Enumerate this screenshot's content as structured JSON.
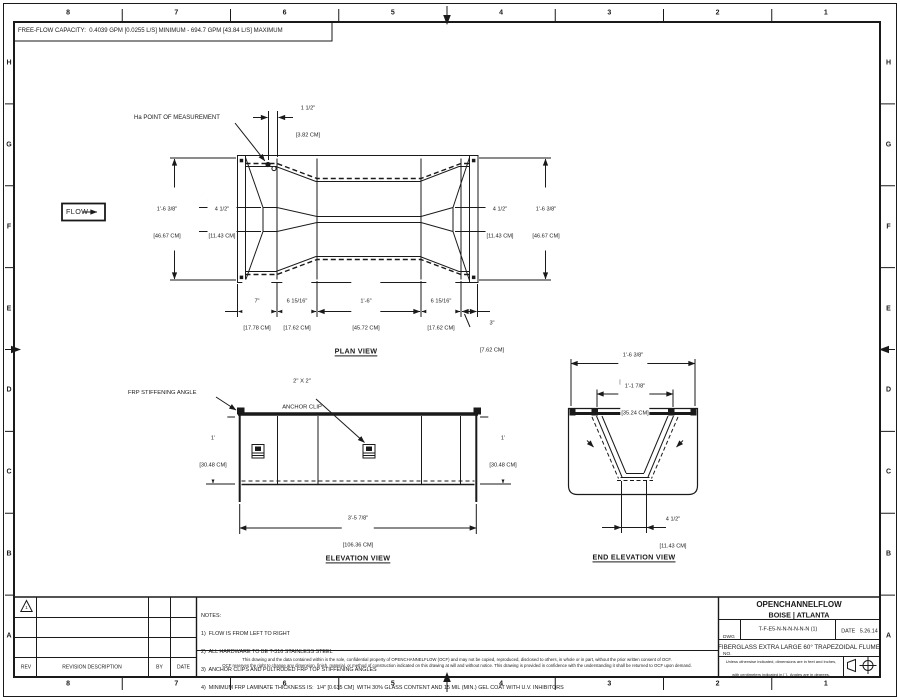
{
  "theme": {
    "line_color": "#1a1a1a",
    "background_color": "#ffffff"
  },
  "sheet": {
    "free_flow_capacity": "FREE-FLOW CAPACITY:  0.4039 GPM [0.0255 L/S] MINIMUM - 694.7 GPM [43.84 L/S] MAXIMUM"
  },
  "border": {
    "cols": [
      "8",
      "7",
      "6",
      "5",
      "4",
      "3",
      "2",
      "1"
    ],
    "rows": [
      "H",
      "G",
      "F",
      "E",
      "D",
      "C",
      "B",
      "A"
    ]
  },
  "plan": {
    "title": "PLAN VIEW",
    "flow_label": "FLOW",
    "ha_label": "Ha POINT OF MEASUREMENT",
    "dims": {
      "gap": {
        "in": "1 1/2\"",
        "cm": "[3.82 CM]"
      },
      "left_width": {
        "in": "1'-6 3/8\"",
        "cm": "[46.67 CM]"
      },
      "left_throat": {
        "in": "4 1/2\"",
        "cm": "[11.43 CM]"
      },
      "right_throat": {
        "in": "4 1/2\"",
        "cm": "[11.43 CM]"
      },
      "right_width": {
        "in": "1'-6 3/8\"",
        "cm": "[46.67 CM]"
      },
      "len1": {
        "in": "7\"",
        "cm": "[17.78 CM]"
      },
      "len2": {
        "in": "6 15/16\"",
        "cm": "[17.62 CM]"
      },
      "len3": {
        "in": "1'-6\"",
        "cm": "[45.72 CM]"
      },
      "len4": {
        "in": "6 15/16\"",
        "cm": "[17.62 CM]"
      },
      "len5": {
        "in": "3\"",
        "cm": "[7.62 CM]"
      }
    }
  },
  "elevation": {
    "title": "ELEVATION VIEW",
    "frp_label": "FRP STIFFENING ANGLE",
    "clip_label_1": "2\" X 2\"",
    "clip_label_2": "ANCHOR CLIP",
    "dims": {
      "height_left": {
        "in": "1'",
        "cm": "[30.48 CM]"
      },
      "height_right": {
        "in": "1'",
        "cm": "[30.48 CM]"
      },
      "length": {
        "in": "3'-5 7/8\"",
        "cm": "[106.36 CM]"
      }
    }
  },
  "end_elevation": {
    "title": "END ELEVATION VIEW",
    "dims": {
      "top_width": {
        "in": "1'-6 3/8\"",
        "cm": "[46.67 CM]"
      },
      "inner_width": {
        "in": "1'-1 7/8\"",
        "cm": "[35.24 CM]"
      },
      "bottom_width": {
        "in": "4 1/2\"",
        "cm": "[11.43 CM]"
      }
    }
  },
  "notes": {
    "line0": "NOTES:",
    "line1": "1)  FLOW IS FROM LEFT TO RIGHT",
    "line2": "2)  ALL HARDWARE TO BE T-316 STAINLESS STEEL",
    "line3": "3)  ANCHOR CLIPS AND PULTRUDED FRP TOP STIFFENING ANGLES",
    "line4": "4)  MINIMUM FRP LAMINATE THICKNESS IS:  1/4\" [0.635 CM]  WITH 30% GLASS CONTENT AND 15 MIL (MIN.) GEL COAT WITH U.V. INHIBITORS"
  },
  "disclaimer": {
    "line1": "This drawing and the data contained within is the sole, confidential property of OPENCHANNELFLOW (OCF) and may not be copied, reproduced, disclosed to others, in whole or in part, without the prior written consent of OCF.",
    "line2": "OCF reserves the right to change any dimension, finish, material, or method of construction indicated on this drawing at will and without notice.  This drawing is provided in confidence with the understanding it shall be returned to OCF upon demand."
  },
  "revision_table": {
    "rev_header": "REV",
    "description_header": "REVISION DESCRIPTION",
    "by_header": "BY",
    "date_header": "DATE",
    "triangle_label": "1"
  },
  "title_block": {
    "company": "OPENCHANNELFLOW",
    "locations": "BOISE | ATLANTA",
    "dwg_label_1": "DWG",
    "dwg_label_2": "NO.",
    "dwg_no": "T-F-E5-N-N-N-N-N-N (1)",
    "date_label": "DATE",
    "date": "5.26.14",
    "drawing_title": "FIBERGLASS EXTRA LARGE 60° TRAPEZOIDAL FLUME",
    "units_note_1": "Unless otherwise indicated, dimensions are in feet and inches,",
    "units_note_2": "with centimeters indicated in [ ].  Angles are in degrees."
  }
}
